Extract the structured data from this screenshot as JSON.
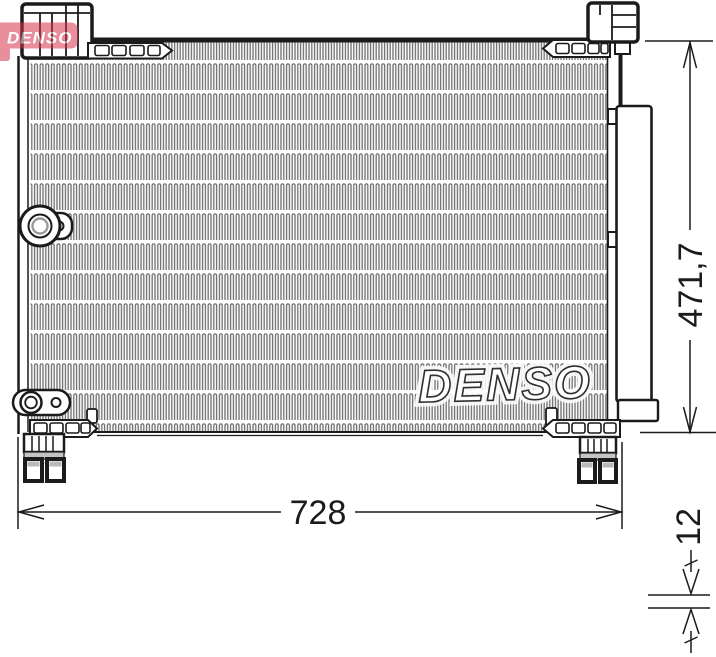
{
  "drawing": {
    "kind": "condenser technical drawing"
  },
  "watermark": {
    "brand": "DENSO"
  },
  "logo": {
    "brand": "DENSO"
  },
  "dimensions": {
    "height_label": "471,7",
    "width_label": "728",
    "depth_label": "12"
  },
  "colors": {
    "line": "#1b1b1b",
    "fin_gray": "#6e6e6e",
    "brand_red": "#d6334d",
    "background": "#ffffff"
  }
}
